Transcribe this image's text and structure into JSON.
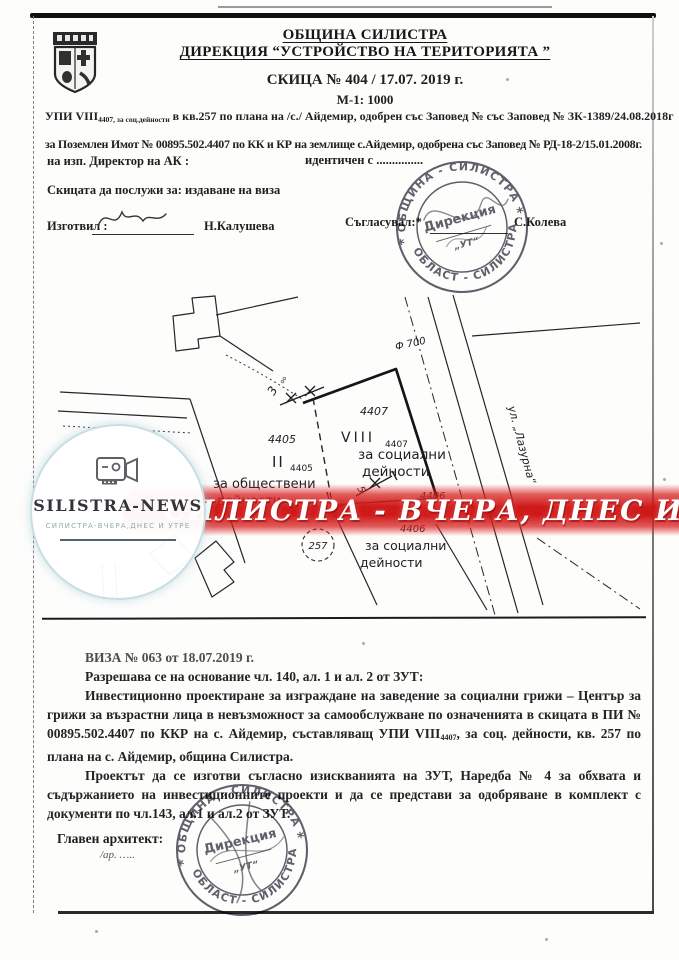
{
  "header": {
    "org_line1": "ОБЩИНА СИЛИСТРА",
    "org_line2": "ДИРЕКЦИЯ “УСТРОЙСТВО НА ТЕРИТОРИЯТА ”",
    "sketch_no": "СКИЦА № 404 / 17.07. 2019 г.",
    "scale": "М-1: 1000"
  },
  "intro": {
    "upi_prefix": "УПИ VIII",
    "upi_sub": "4407, за соц.дейности",
    "upi_rest": " в кв.257 по плана на /с./ Айдемир, одобрен със Заповед № със Заповед № ЗК-1389/24.08.2018г",
    "parcel_line": "за Поземлен Имот № 00895.502.4407 по КК и КР на землище с.Айдемир, одобрена със Заповед № РД-18-2/15.01.2008г.",
    "director_line": "на изп. Директор на АК :",
    "identical_line": "идентичен с ...............",
    "purpose_line": "Скицата да послужи за: издаване на виза",
    "prepared_label": "Изготвил :",
    "prepared_name": "Н.Калушева",
    "agreed_label": "Съгласувал:*",
    "agreed_name": "С.Колева"
  },
  "map": {
    "labels": {
      "phi700": "Ф 700",
      "street": "ул. „Лазурна“",
      "p4407_top": "4407",
      "p4407_roman": "VIII",
      "p4407_sub": "4407",
      "p4407_use1": "за социални",
      "p4407_use2": "дейности",
      "p4405_num": "4405",
      "p4405_roman": "II",
      "p4405_sub": "4405",
      "p4405_use1": "за обществени",
      "p4405_use2": "дейности",
      "p4405_ik": "ик",
      "p4406_num1": "4406",
      "p4406_num2": "4406",
      "p4406_use1": "за социални",
      "p4406_use2": "дейности",
      "quarter": "257",
      "dim3a": "3",
      "dim3a_sup": "оо",
      "dim3b": "3",
      "dim5": "5"
    }
  },
  "stamp": {
    "top_arc": "ОБЩИНА - СИЛИСТРА",
    "bottom_arc": "ОБЛАСТ - СИЛИСТРА",
    "center1": "Дирекция",
    "center2": "„УТ“",
    "star_left": "*",
    "star_right": "*"
  },
  "logo": {
    "title": "SILISTRA-NEWS",
    "subtitle": "СИЛИСТРА-ВЧЕРА,ДНЕС И УТРЕ"
  },
  "banner": {
    "text": "СИЛИСТРА - ВЧЕРА, ДНЕС И УТРЕ",
    "color": "#cd1212"
  },
  "visa": {
    "line1": "ВИЗА № 063 от 18.07.2019 г.",
    "line2": "Разрешава се на основание чл. 140, ал. 1 и ал. 2 от ЗУТ:",
    "para1_a": "Инвестиционно проектиране за изграждане на заведение за социални грижи – Център за грижи за възрастни лица в невъзможност за самообслужване по означенията в скицата в ПИ № 00895.502.4407 по ККР на с. Айдемир, съставляващ УПИ VIII",
    "para1_sub": "4407",
    "para1_b": ", за соц. дейности, кв. 257 по плана на с. Айдемир, община Силистра.",
    "para2": "Проектът да се изготви съгласно изискванията на ЗУТ, Наредба № 4 за обхвата и съдържанието на инвестиционните проекти и да се представи за одобряване в комплект с документи по чл.143, ал.1 и ал.2 от ЗУТ.",
    "architect_label": "Главен архитект:",
    "architect_sig": "/ар. ….."
  }
}
